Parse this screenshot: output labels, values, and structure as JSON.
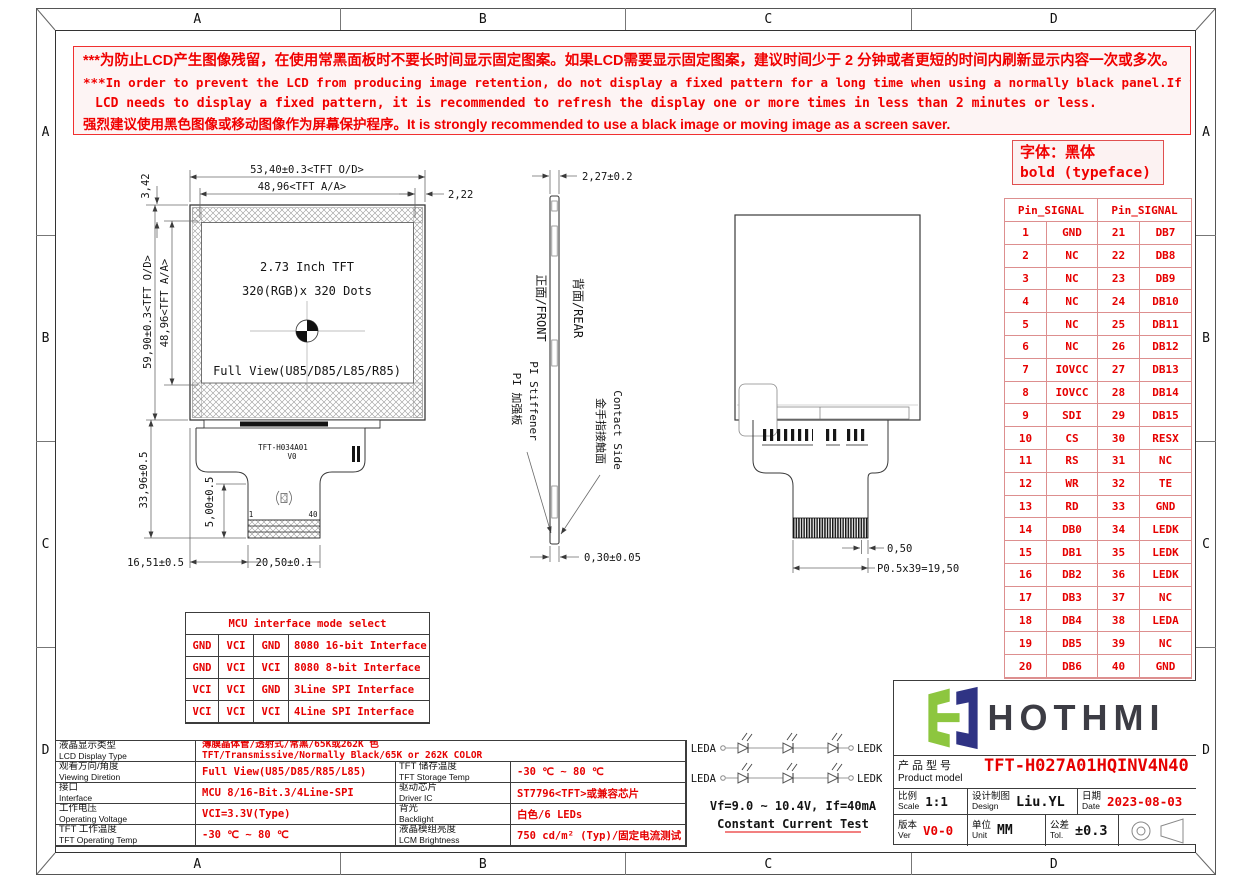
{
  "colors": {
    "red_text": "#e60000",
    "warning_red": "#f00000",
    "pin_table_border": "#dd8f8f",
    "logo_green": "#8dc63f",
    "logo_navy": "#2f3384",
    "line_dark": "#3a3a3a"
  },
  "frame": {
    "zone_letters": [
      "A",
      "B",
      "C",
      "D"
    ]
  },
  "warning": {
    "lines": [
      "***为防止LCD产生图像残留，在使用常黑面板时不要长时间显示固定图案。如果LCD需要显示固定图案，建议时间少于 2 分钟或者更短的时间内刷新显示内容一次或多次。",
      "***In order to prevent the LCD from producing image retention, do not display a fixed pattern for a long time when using a normally black panel.If the",
      "LCD needs to display a fixed pattern, it is recommended to refresh the display one or more times in less than 2 minutes or less.",
      "强烈建议使用黑色图像或移动图像作为屏幕保护程序。It is strongly recommended to use a black image or moving image as a screen saver."
    ]
  },
  "font_note": {
    "line1": "字体：黑体",
    "line2": "bold (typeface)"
  },
  "pin_table": {
    "header_left": "Pin_SIGNAL",
    "header_right": "Pin_SIGNAL",
    "rows": [
      {
        "p1": "1",
        "s1": "GND",
        "p2": "21",
        "s2": "DB7"
      },
      {
        "p1": "2",
        "s1": "NC",
        "p2": "22",
        "s2": "DB8"
      },
      {
        "p1": "3",
        "s1": "NC",
        "p2": "23",
        "s2": "DB9"
      },
      {
        "p1": "4",
        "s1": "NC",
        "p2": "24",
        "s2": "DB10"
      },
      {
        "p1": "5",
        "s1": "NC",
        "p2": "25",
        "s2": "DB11"
      },
      {
        "p1": "6",
        "s1": "NC",
        "p2": "26",
        "s2": "DB12"
      },
      {
        "p1": "7",
        "s1": "IOVCC",
        "p2": "27",
        "s2": "DB13"
      },
      {
        "p1": "8",
        "s1": "IOVCC",
        "p2": "28",
        "s2": "DB14"
      },
      {
        "p1": "9",
        "s1": "SDI",
        "p2": "29",
        "s2": "DB15"
      },
      {
        "p1": "10",
        "s1": "CS",
        "p2": "30",
        "s2": "RESX"
      },
      {
        "p1": "11",
        "s1": "RS",
        "p2": "31",
        "s2": "NC"
      },
      {
        "p1": "12",
        "s1": "WR",
        "p2": "32",
        "s2": "TE"
      },
      {
        "p1": "13",
        "s1": "RD",
        "p2": "33",
        "s2": "GND"
      },
      {
        "p1": "14",
        "s1": "DB0",
        "p2": "34",
        "s2": "LEDK"
      },
      {
        "p1": "15",
        "s1": "DB1",
        "p2": "35",
        "s2": "LEDK"
      },
      {
        "p1": "16",
        "s1": "DB2",
        "p2": "36",
        "s2": "LEDK"
      },
      {
        "p1": "17",
        "s1": "DB3",
        "p2": "37",
        "s2": "NC"
      },
      {
        "p1": "18",
        "s1": "DB4",
        "p2": "38",
        "s2": "LEDA"
      },
      {
        "p1": "19",
        "s1": "DB5",
        "p2": "39",
        "s2": "NC"
      },
      {
        "p1": "20",
        "s1": "DB6",
        "p2": "40",
        "s2": "GND"
      }
    ]
  },
  "mcu_table": {
    "title": "MCU interface mode select",
    "rows": [
      [
        "GND",
        "VCI",
        "GND",
        "8080 16-bit Interface"
      ],
      [
        "GND",
        "VCI",
        "VCI",
        "8080 8-bit Interface"
      ],
      [
        "VCI",
        "VCI",
        "GND",
        "3Line SPI Interface"
      ],
      [
        "VCI",
        "VCI",
        "VCI",
        "4Line SPI Interface"
      ]
    ]
  },
  "spec_table": {
    "row1": {
      "label_zh": "液晶显示类型",
      "label_en": "LCD Display Type",
      "value_zh": "薄膜晶体管/透射式/常黑/65K或262K 色",
      "value_en": "TFT/Transmissive/Normally Black/65K or 262K COLOR"
    },
    "rows": [
      {
        "l_zh": "观看方向/角度",
        "l_en": "Viewing Diretion",
        "l_val": "Full View(U85/D85/R85/L85)",
        "r_zh": "TFT 储存温度",
        "r_en": "TFT Storage Temp",
        "r_val": "-30 ℃ ~ 80 ℃"
      },
      {
        "l_zh": "接口",
        "l_en": "Interface",
        "l_val": "MCU 8/16-Bit.3/4Line-SPI",
        "r_zh": "驱动芯片",
        "r_en": "Driver IC",
        "r_val": "ST7796<TFT>或兼容芯片"
      },
      {
        "l_zh": "工作电压",
        "l_en": "Operating Voltage",
        "l_val": "VCI=3.3V(Type)",
        "r_zh": "背光",
        "r_en": "Backlight",
        "r_val": "白色/6 LEDs"
      },
      {
        "l_zh": "TFT 工作温度",
        "l_en": "TFT Operating Temp",
        "l_val": "-30 ℃ ~ 80 ℃",
        "r_zh": "液晶模组亮度",
        "r_en": "LCM Brightness",
        "r_val": "750 cd/m² (Typ)/固定电流测试"
      }
    ]
  },
  "front_view": {
    "dim_od_w": "53,40±0.3<TFT O/D>",
    "dim_aa_w": "48,96<TFT A/A>",
    "dim_side": "2,22",
    "dim_top": "3,42",
    "dim_od_h": "59,90±0.3<TFT O/D>",
    "dim_aa_h": "48,96<TFT A/A>",
    "dim_fpc_h": "33,96±0.5",
    "dim_tail": "5,00±0.5",
    "dim_offset": "16,51±0.5",
    "dim_tail_w": "20,50±0.1",
    "label1": "2.73 Inch TFT",
    "label2": "320(RGB)x 320 Dots",
    "label3": "Full View(U85/D85/L85/R85)",
    "fpc_name": "TFT-H034A01",
    "fpc_ver": "V0",
    "pin_first": "1",
    "pin_last": "40"
  },
  "side_view": {
    "dim_thickness": "2,27±0.2",
    "dim_fpc_t": "0,30±0.05",
    "front_label": "正面/FRONT",
    "rear_label": "背面/REAR",
    "stiffener_zh": "PI 加强板",
    "stiffener_en": "PI Stiffener",
    "contact_zh": "金手指接触面",
    "contact_en": "Contact Side"
  },
  "rear_view": {
    "dim_pitch": "0,50",
    "dim_pins": "P0.5x39=19,50"
  },
  "led_circuit": {
    "anode_label": "LEDA",
    "cathode_label": "LEDK",
    "note1": "Vf=9.0 ~ 10.4V, If=40mA",
    "note2": "Constant Current Test"
  },
  "title_block": {
    "brand": "HOTHMI",
    "product_zh": "产品型号",
    "product_en": "Product model",
    "model": "TFT-H027A01HQINV4N40",
    "scale_zh": "比例",
    "scale_en": "Scale",
    "scale": "1:1",
    "design_zh": "设计制图",
    "design_en": "Design",
    "designer": "Liu.YL",
    "date_zh": "日期",
    "date_en": "Date",
    "date": "2023-08-03",
    "ver_zh": "版本",
    "ver_en": "Ver",
    "ver": "V0-0",
    "unit_zh": "单位",
    "unit_en": "Unit",
    "unit": "MM",
    "tol_zh": "公差",
    "tol_en": "Tol.",
    "tol": "±0.3"
  }
}
